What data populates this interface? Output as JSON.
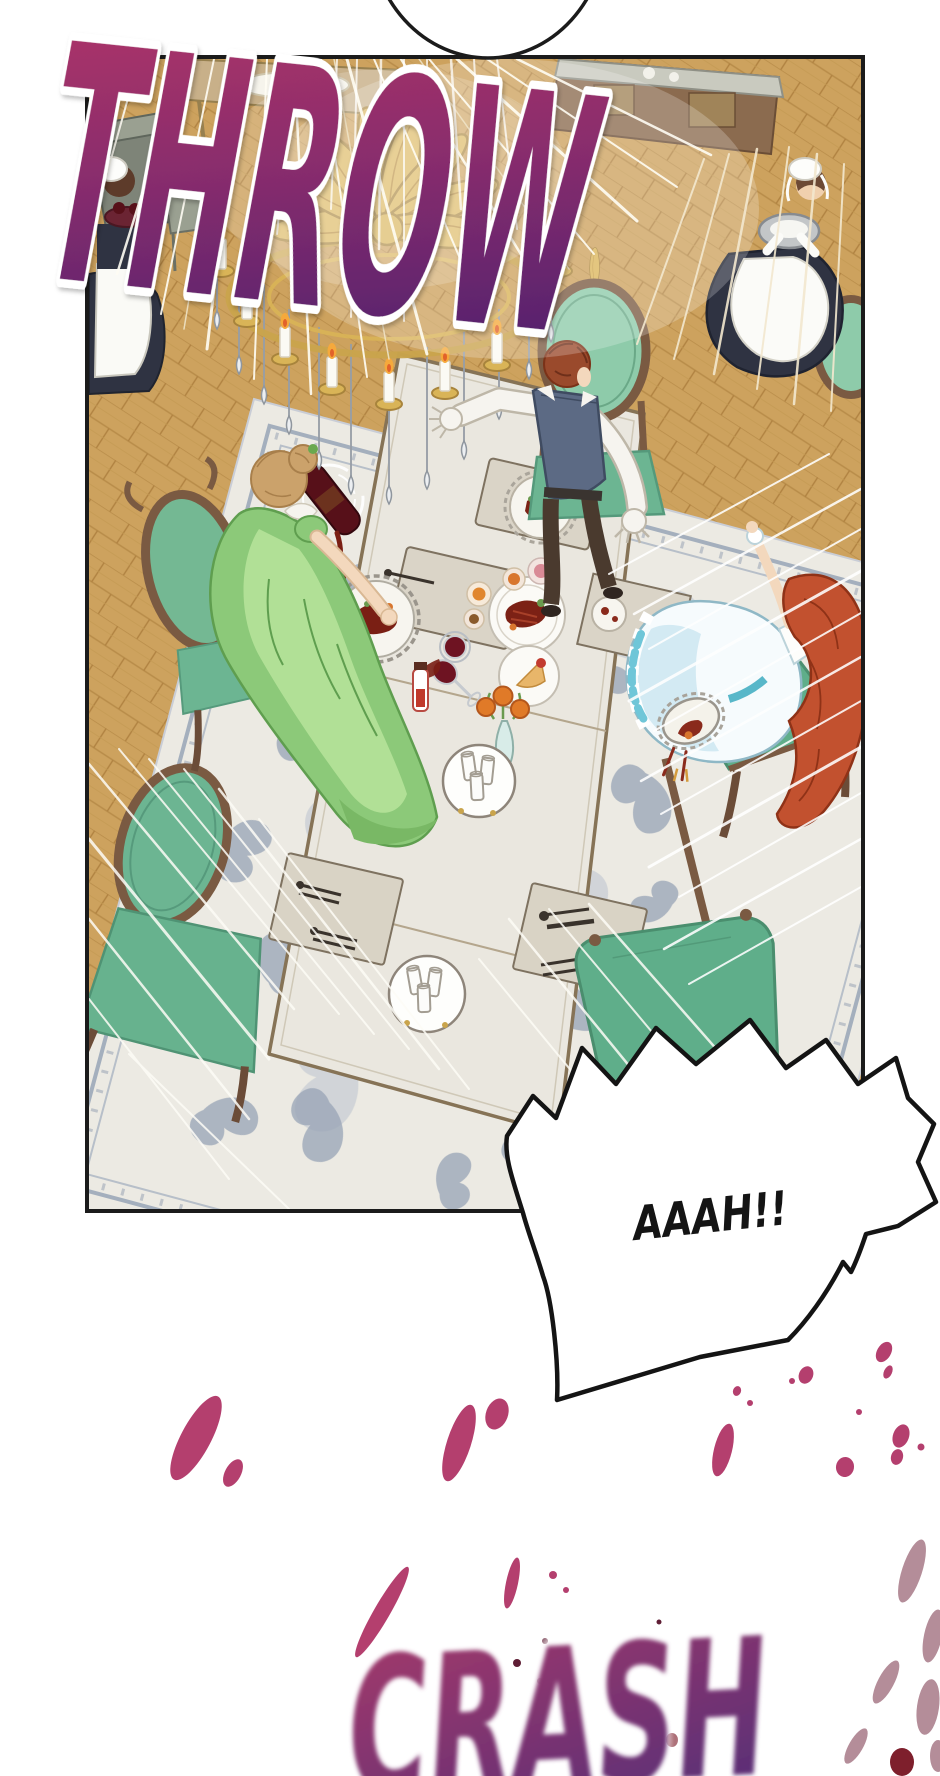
{
  "sfx": {
    "throw": "THROW",
    "crash": "CRASH"
  },
  "speech_bubble": {
    "text": "AAAH!!"
  },
  "colors": {
    "sfx_gradient_start": "#b53467",
    "sfx_gradient_mid": "#8a2d6d",
    "sfx_gradient_end": "#55226e",
    "crash_gradient_start": "#a83a6a",
    "crash_gradient_end": "#5d2f76",
    "splatter": "#b43f6e",
    "splatter_muted": "#b48d99",
    "splatter_dark": "#5e1d34",
    "splatter_wine": "#7e1f2c",
    "panel_border": "#1b1b1b",
    "floor_wood": "#cda25e",
    "rug_base": "#eceae3",
    "rug_pattern": "#97a3b5",
    "table_top": "#eae7df",
    "chair_green": "#6cb592",
    "chair_wood": "#7a5a42",
    "dress_green": "#8cc979",
    "hair_red": "#c2512f",
    "hair_auburn": "#9a4a2c",
    "vest_blue": "#5c6a84",
    "maid_uniform": "#2f3342",
    "chandelier_gold": "#d9b457"
  }
}
